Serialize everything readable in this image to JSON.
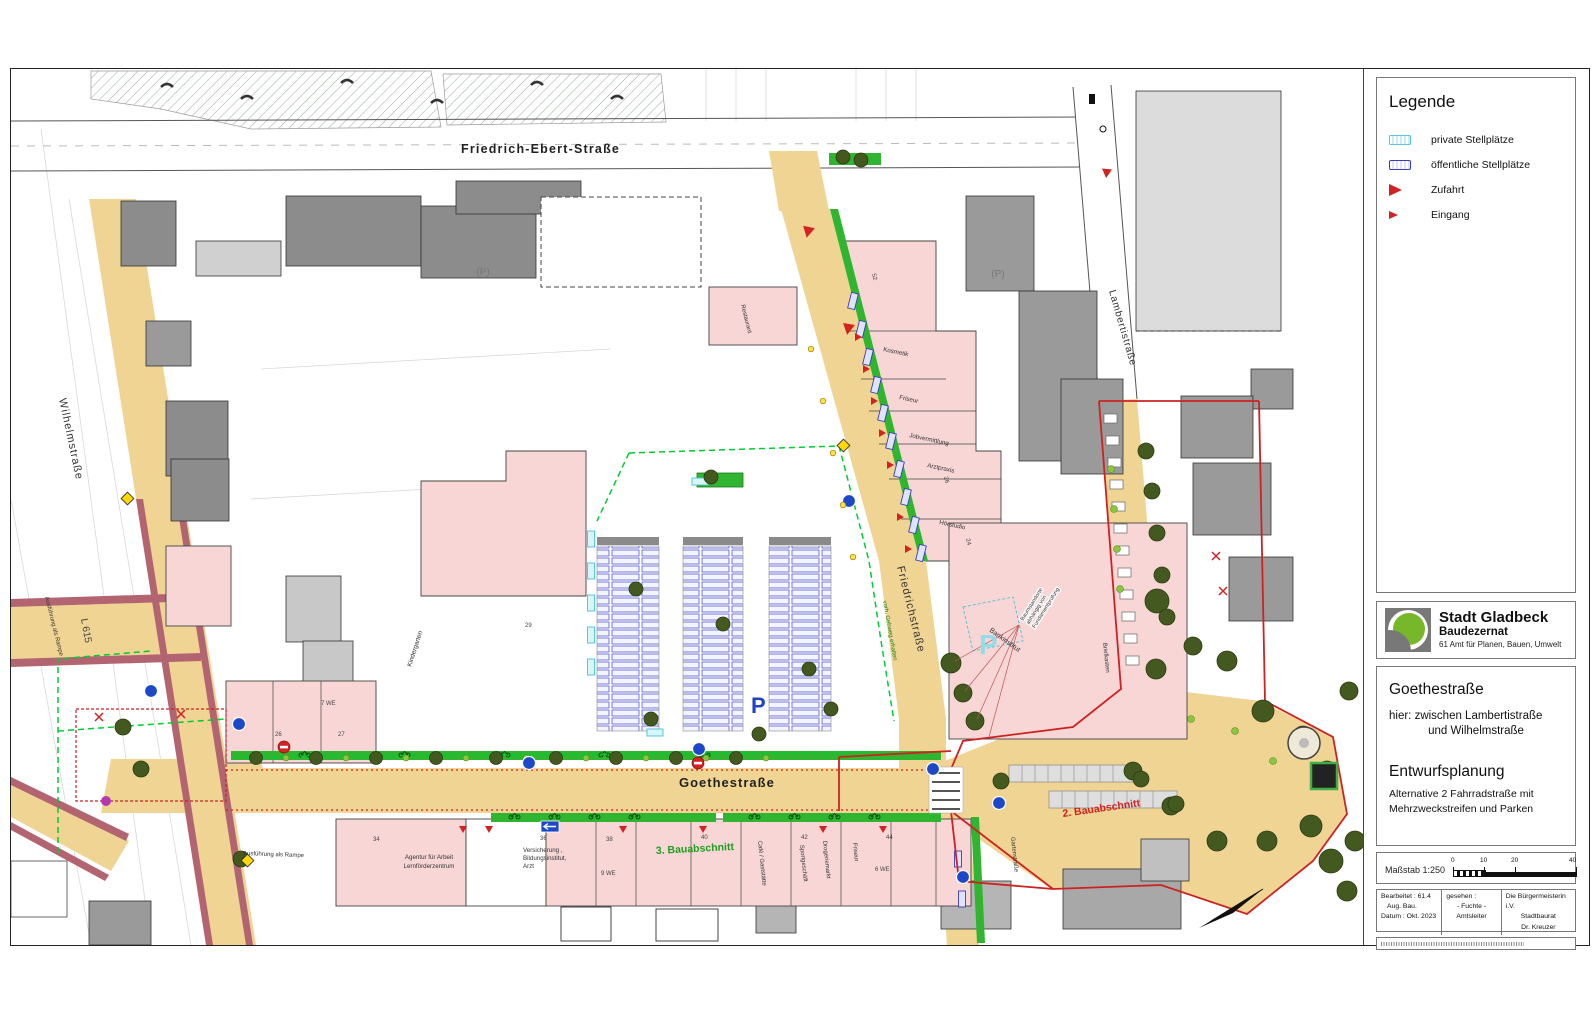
{
  "sheet": {
    "legend": {
      "title": "Legende",
      "items": [
        {
          "icon": "private-parking-stamp",
          "label": "private Stellplätze"
        },
        {
          "icon": "public-parking-stamp",
          "label": "öffentliche Stellplätze"
        },
        {
          "icon": "access-triangle",
          "label": "Zufahrt"
        },
        {
          "icon": "entrance-triangle",
          "label": "Eingang"
        }
      ]
    },
    "agency": {
      "city": "Stadt Gladbeck",
      "department": "Baudezernat",
      "office": "61 Amt für Planen, Bauen, Umwelt"
    },
    "project": {
      "street": "Goethestraße",
      "location_line1": "hier: zwischen Lambertistraße",
      "location_line2": "und Wilhelmstraße",
      "plan_type": "Entwurfsplanung",
      "variant_line1": "Alternative 2 Fahrradstraße mit",
      "variant_line2": "Mehrzweckstreifen und Parken"
    },
    "scale": {
      "label": "Maßstab 1:250",
      "ticks": [
        "0",
        "10",
        "20",
        "40"
      ]
    },
    "approval": {
      "edited": "Bearbeitet : 61.4",
      "edited_detail": "Aug.    Bau.",
      "date": "Datum : Okt. 2023",
      "seen": "gesehen :",
      "seen_name": "- Fuchte -",
      "seen_role": "Amtsleiter",
      "mayor": "Die Bürgermeisterin",
      "mayor_iv": "i.V.",
      "mayor_deputy_role": "Stadtbaurat",
      "mayor_deputy": "Dr. Kreuzer"
    }
  },
  "map": {
    "street_names": {
      "friedrich_ebert": "Friedrich-Ebert-Straße",
      "wilhelm": "Wilhelmstraße",
      "friedrich": "Friedrichstraße",
      "lamberti": "Lambertistraße",
      "goethe": "Goethestraße",
      "l615": "L 615"
    },
    "phase_labels": {
      "phase2": "2. Bauabschnitt",
      "phase3": "3. Bauabschnitt"
    },
    "pois": {
      "restaurant": "Restaurant",
      "kosmetik": "Kosmetik",
      "friseur": "Friseur",
      "jobvermittlung": "Jobvermittlung",
      "arztpraxis": "Arztpraxis",
      "hoerstudio": "Hörstudio",
      "bankinstitut": "Bankinstitut",
      "briefkasten": "Briefkasten",
      "kindergarten": "Kindergarten",
      "cafe": "Café / Gaststätte",
      "sportgeschaeft": "Sportgeschäft",
      "drogeriemarkt": "Drogeriemarkt",
      "friseur_sued": "Friseur",
      "gartenstrasse": "Gartenstraße",
      "agentur_zeile1": "Agentur für Arbeit",
      "agentur_zeile2": "Lernförderzentrum",
      "versicherung_zeile1": "Versicherung ,",
      "versicherung_zeile2": "Bildungsinstitut,",
      "versicherung_zeile3": "Arzt"
    },
    "annotations": {
      "rampe": "Ausführung als Rampe",
      "gehweg": "vorh. Gehweg erhalten",
      "baum_zeile1": "Baumstandorte",
      "baum_zeile2": "abhängig von",
      "baum_zeile3": "Fundamentprüfung",
      "parkhaus_bestand": "(P)",
      "parken_blau": "P",
      "parken_privat": "P"
    },
    "house_numbers": {
      "n34": "34",
      "n36": "36",
      "n38": "38",
      "n40": "40",
      "n42": "42",
      "n44": "44",
      "n29": "29",
      "n26": "26",
      "n27": "27",
      "n24": "24",
      "n26b": "26",
      "n52": "52",
      "we7": "7 WE",
      "we9": "9 WE",
      "we6": "6 WE"
    }
  },
  "colors": {
    "street_yellow": "#f0d494",
    "sidewalk_maroon": "#b26470",
    "building_pink": "#f8d6d6",
    "building_gray_dark": "#8c8c8c",
    "building_gray_light": "#dcdcdc",
    "bike_green": "#2fb52f",
    "tree_green": "#44591f",
    "boundary_red": "#cc2222",
    "construction_green_dash": "#00cc33",
    "public_parking_blue": "#3a3ac0",
    "private_parking_cyan": "#54c7d8",
    "legend_arrow_red": "#d22222"
  }
}
